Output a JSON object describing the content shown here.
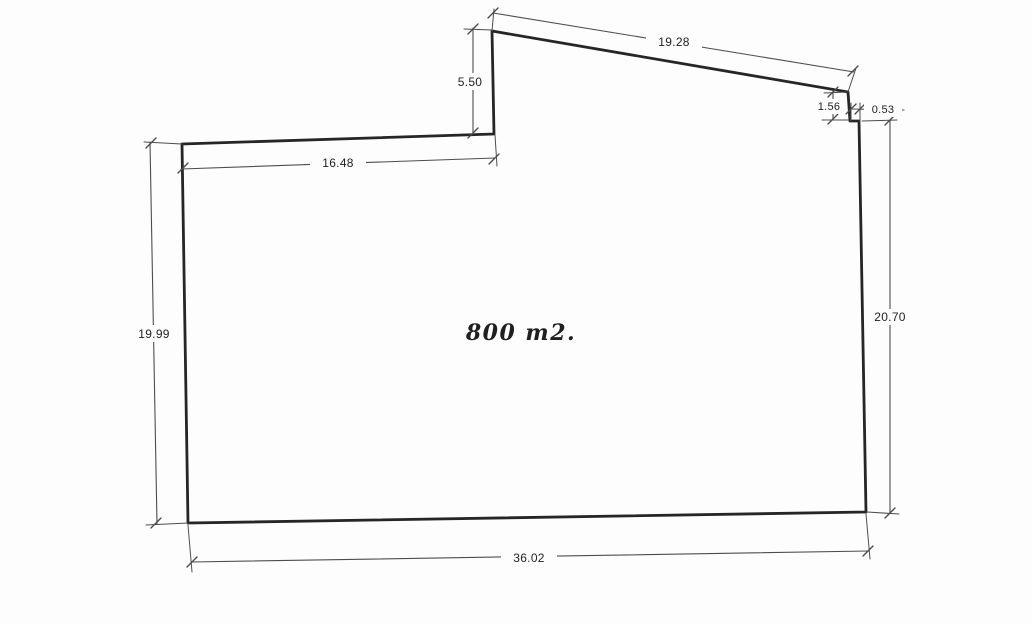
{
  "drawing": {
    "area_label": "800 m2.",
    "dimensions": {
      "top_slanted_edge": "19.28",
      "upper_left_vertical_edge": "5.50",
      "upper_left_horizontal_edge": "16.48",
      "right_notch_vertical": "1.56",
      "right_notch_horizontal": "0.53",
      "left_edge": "19.99",
      "right_edge": "20.70",
      "bottom_edge": "36.02"
    },
    "colors": {
      "page_background": "#fdfdfd",
      "boundary_ink": "#262626",
      "dimension_ink": "#4d4d4d",
      "label_ink": "#1f1f1f"
    }
  }
}
